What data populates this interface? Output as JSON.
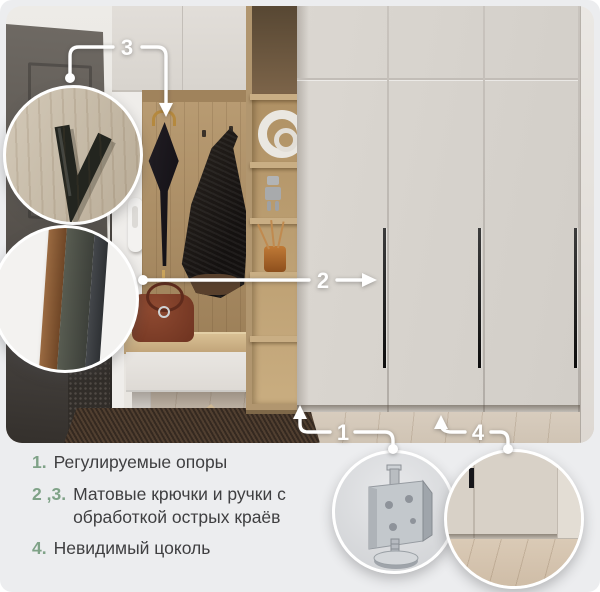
{
  "annotations": {
    "one": "1",
    "two": "2",
    "three": "3",
    "four": "4"
  },
  "features": [
    {
      "num": "1.",
      "text": "Регулируемые опоры"
    },
    {
      "num": "2 ,3.",
      "text": "Матовые крючки и ручки с обработкой острых краёв"
    },
    {
      "num": "4.",
      "text": "Невидимый цоколь"
    }
  ],
  "callouts": [
    {
      "name": "matte-hook-closeup"
    },
    {
      "name": "edge-profile-closeup"
    },
    {
      "name": "adjustable-foot-closeup"
    },
    {
      "name": "invisible-plinth-closeup"
    }
  ],
  "colors": {
    "accent_green": "#7fa287",
    "background": "#ecedef",
    "annotation_white": "#ffffff",
    "wardrobe_beige": "#d6d2cc",
    "wood_oak": "#b2977b",
    "text": "#3f3f41"
  }
}
